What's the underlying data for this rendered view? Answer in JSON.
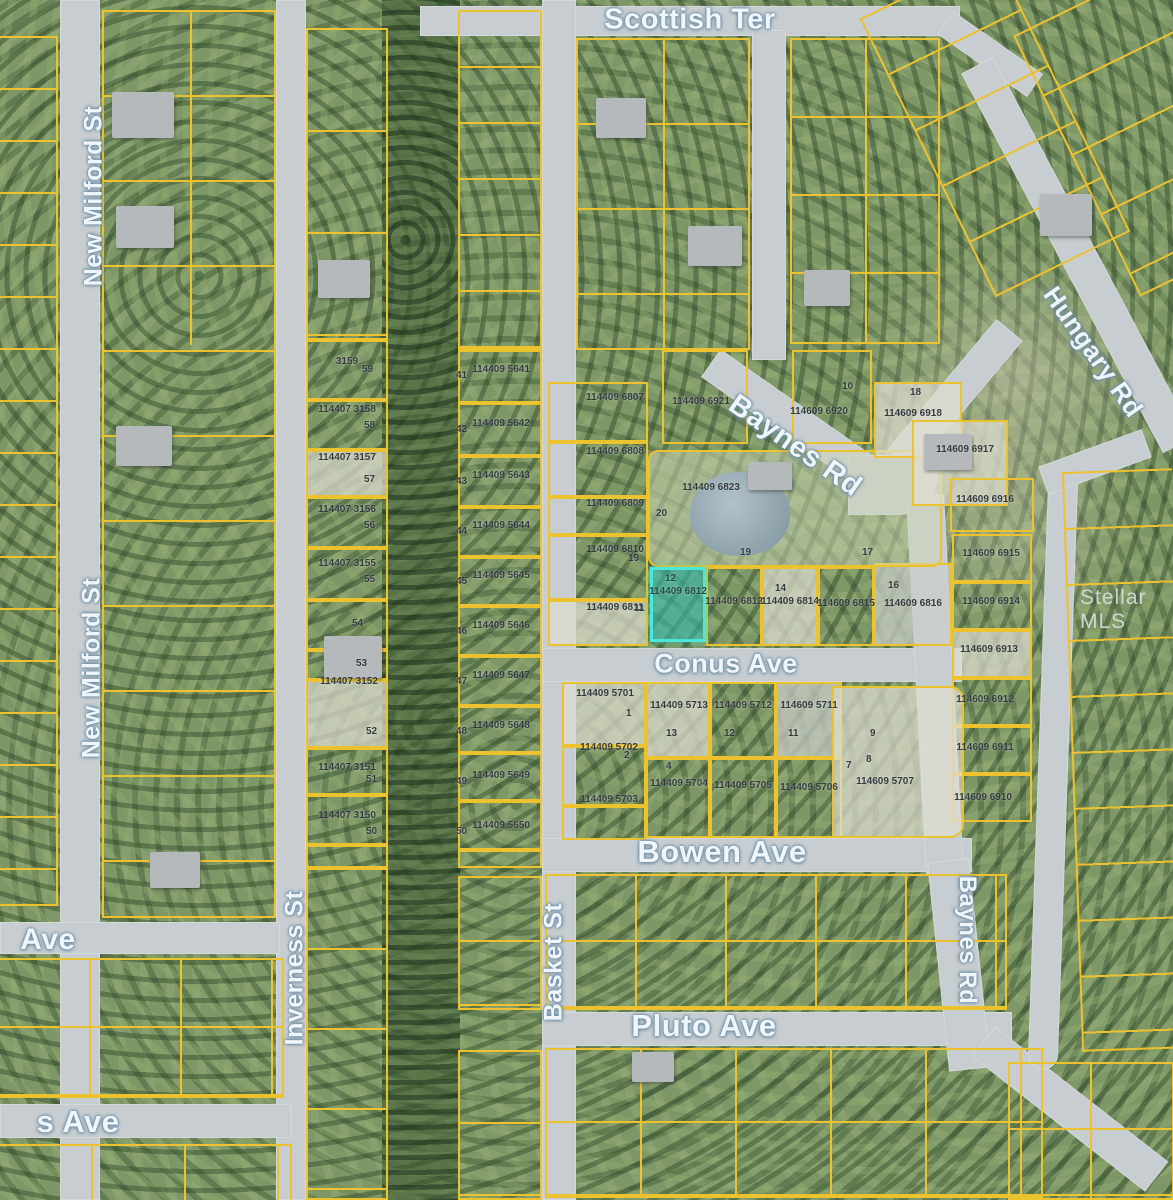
{
  "map": {
    "watermark": "Stellar MLS",
    "colors": {
      "parcel_line": "#ecc22e",
      "highlight_fill": "#2fbdb4",
      "highlight_border": "#4ae8dc",
      "road": "#c7cdd0"
    },
    "streets": {
      "scottish_ter": "Scottish Ter",
      "new_milford_upper": "New Milford St",
      "new_milford_lower": "New Milford St",
      "inverness": "Inverness St",
      "basket": "Basket St",
      "baynes_diagonal": "Baynes Rd",
      "baynes_vertical": "Baynes Rd",
      "hungary": "Hungary Rd",
      "conus": "Conus Ave",
      "bowen": "Bowen Ave",
      "pluto": "Pluto Ave",
      "ave_partial": "Ave",
      "s_ave_partial": "s Ave"
    },
    "highlight": {
      "id": "114409 6812",
      "lot": "12"
    },
    "parcels": {
      "milford_st": [
        {
          "id": "3159",
          "lot": "59"
        },
        {
          "id": "114407 3158",
          "lot": "58"
        },
        {
          "id": "114407 3157",
          "lot": "57"
        },
        {
          "id": "114407 3156",
          "lot": "56"
        },
        {
          "id": "114407 3155",
          "lot": "55"
        },
        {
          "id": "",
          "lot": "54"
        },
        {
          "id": "",
          "lot": "53"
        },
        {
          "id": "114407 3152",
          "lot": "52"
        },
        {
          "id": "114407 3151",
          "lot": "51"
        },
        {
          "id": "114407 3150",
          "lot": "50"
        }
      ],
      "basket_st": [
        {
          "id": "114409 5641",
          "lot": "41"
        },
        {
          "id": "114409 5642",
          "lot": "42"
        },
        {
          "id": "114409 5643",
          "lot": "43"
        },
        {
          "id": "114409 5644",
          "lot": "44"
        },
        {
          "id": "114409 5645",
          "lot": "45"
        },
        {
          "id": "114409 5646",
          "lot": "46"
        },
        {
          "id": "114409 5647",
          "lot": "47"
        },
        {
          "id": "114409 5648",
          "lot": "48"
        },
        {
          "id": "114409 5649",
          "lot": "49"
        },
        {
          "id": "114409 5650",
          "lot": "50"
        }
      ],
      "conus_col": [
        {
          "id": "114409 6807",
          "lot": ""
        },
        {
          "id": "114409 6808",
          "lot": ""
        },
        {
          "id": "114409 6809",
          "lot": ""
        },
        {
          "id": "114409 6810",
          "lot": "19"
        },
        {
          "id": "114409 6811",
          "lot": "11"
        }
      ],
      "conus_row": [
        {
          "id": "114409 6813",
          "lot": ""
        },
        {
          "id": "114409 6814",
          "lot": "14"
        },
        {
          "id": "114609 6815",
          "lot": ""
        },
        {
          "id": "114609 6816",
          "lot": "16"
        }
      ],
      "estate": {
        "id": "114409 6823",
        "lot": "20"
      },
      "baynes_north": [
        {
          "id": "114409 6921",
          "lot": ""
        },
        {
          "id": "114609 6920",
          "lot": ""
        }
      ],
      "hungary_col": [
        {
          "id": "114609 6918",
          "lot": "18"
        },
        {
          "id": "114609 6917",
          "lot": ""
        },
        {
          "id": "114609 6916",
          "lot": ""
        },
        {
          "id": "114609 6915",
          "lot": ""
        },
        {
          "id": "114609 6914",
          "lot": ""
        },
        {
          "id": "114609 6913",
          "lot": ""
        },
        {
          "id": "114609 6912",
          "lot": ""
        },
        {
          "id": "114609 6911",
          "lot": ""
        },
        {
          "id": "114609 6910",
          "lot": ""
        }
      ],
      "bowen_block": [
        {
          "id": "114409 5701",
          "lot": "1"
        },
        {
          "id": "114409 5713",
          "lot": "13"
        },
        {
          "id": "114409 5712",
          "lot": "12"
        },
        {
          "id": "114609 5711",
          "lot": "11"
        },
        {
          "id": "114409 5702",
          "lot": "2"
        },
        {
          "id": "114409 5703",
          "lot": ""
        },
        {
          "id": "114409 5704",
          "lot": "4"
        },
        {
          "id": "114409 5705",
          "lot": ""
        },
        {
          "id": "114409 5706",
          "lot": ""
        },
        {
          "id": "114609 5707",
          "lot": ""
        }
      ],
      "stray_lots": [
        "19",
        "17",
        "10",
        "9",
        "7",
        "8"
      ]
    }
  }
}
